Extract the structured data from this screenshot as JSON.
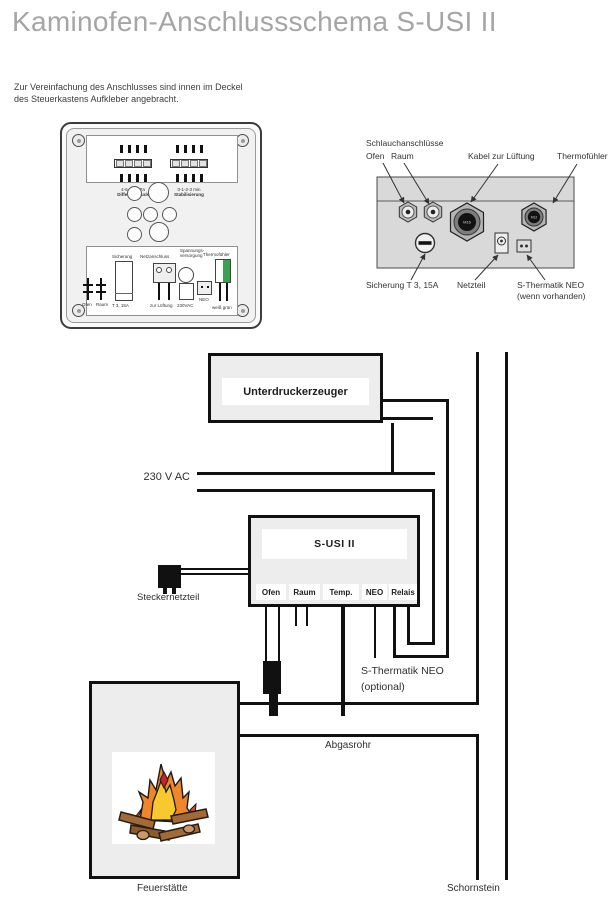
{
  "title": "Kaminofen-Anschlussschema S-USI II",
  "intro": "Zur Vereinfachung des Anschlusses sind innen im Deckel des Steuerkastens Aufkleber angebracht.",
  "control_box": {
    "dip_left_value": "4-6-8-10 Pa",
    "dip_left_label": "Differenzdruck",
    "dip_right_value": "0-1-2-3 min",
    "dip_right_label": "Stabilisierung",
    "bottom_sticker": {
      "ofen": "Ofen",
      "raum": "Raum",
      "sicherung": "Sicherung",
      "sicherung_value": "T 3, 15A",
      "netzanschluss": "Netzanschluss",
      "zur_lueftung": "zur Lüftung",
      "spannung1": "Spannungs-",
      "spannung2": "versorgung",
      "volt": "230VAC",
      "neo": "NEO",
      "thermofuehler": "Thermofühler",
      "wire_colors": "weiß grün"
    }
  },
  "panel": {
    "labels": {
      "schlauchanschluesse": "Schlauchanschlüsse",
      "ofen": "Ofen",
      "raum": "Raum",
      "kabel": "Kabel zur Lüftung",
      "thermofuehler": "Thermofühler",
      "sicherung": "Sicherung T 3, 15A",
      "netzteil": "Netzteil",
      "neo_line1": "S-Thermatik NEO",
      "neo_line2": "(wenn vorhanden)"
    },
    "gland_big": "M16",
    "gland_small": "M12"
  },
  "flow": {
    "voltage": "230 V AC",
    "unterdruckerzeuger": "Unterdruckerzeuger",
    "susi": "S-USI II",
    "ports": [
      "Ofen",
      "Raum",
      "Temp.",
      "NEO",
      "Relais"
    ],
    "steckernetzteil": "Steckernetzteil",
    "neo_optional_1": "S-Thermatik NEO",
    "neo_optional_2": "(optional)",
    "abgasrohr": "Abgasrohr",
    "feuerstaette": "Feuerstätte",
    "schornstein": "Schornstein"
  },
  "colors": {
    "line": "#111111",
    "panel_fill": "#d9d9d9",
    "box_fill": "#ededed",
    "thermo_green": "#3aa052",
    "flame_orange": "#f0862c",
    "flame_yellow": "#f8c92e",
    "flame_red": "#c1272d",
    "log_brown": "#a06a3a"
  }
}
